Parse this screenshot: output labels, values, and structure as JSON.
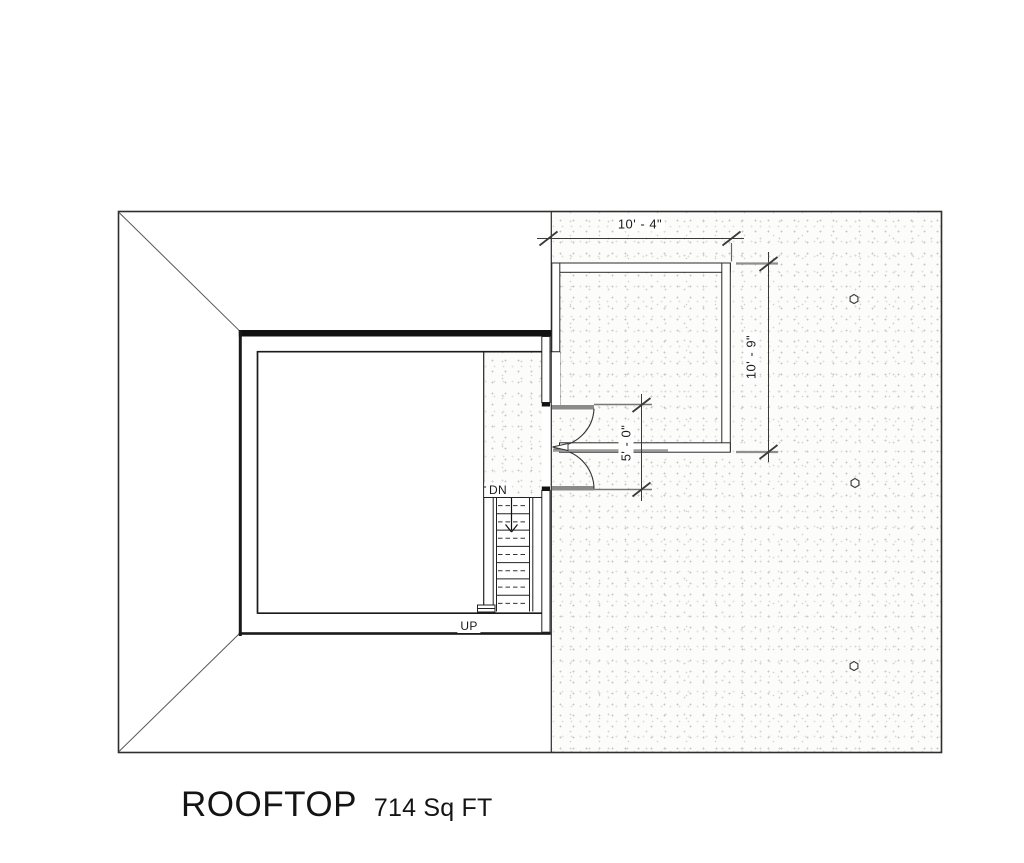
{
  "plan": {
    "title": "ROOFTOP",
    "area_label": "714 Sq FT",
    "stair_labels": {
      "down": "DN",
      "up": "UP"
    },
    "dimensions": {
      "deck_width": "10' - 4\"",
      "deck_depth": "10' - 9\"",
      "door_opening": "5' - 0\""
    },
    "markers": {
      "shape": "hexagon",
      "count": 3
    },
    "colors": {
      "ink": "#1f1f1f",
      "wall_fill": "#111111",
      "dimension_gray": "#8f8f8f",
      "stipple_dot": "#cccccc",
      "paper": "#ffffff"
    }
  }
}
